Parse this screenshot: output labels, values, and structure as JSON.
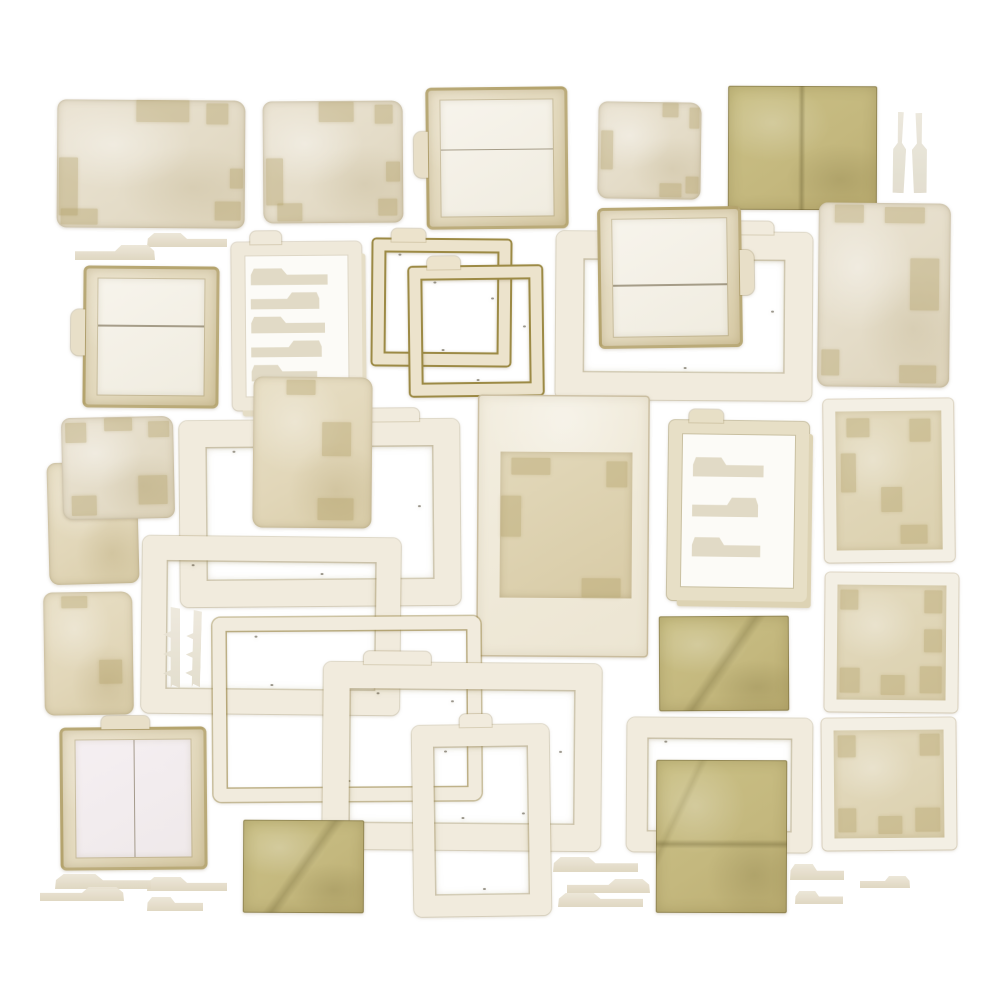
{
  "meta": {
    "description": "Vintage paper ephemera collage: distressed photo frames, file folders, tab strips and olive paper squares laid out on a white background",
    "board": {
      "width": 1000,
      "height": 1000,
      "background": "#ffffff"
    }
  },
  "palette": {
    "background": "#ffffff",
    "cream_paper": "#e9e2d1",
    "tan_paper": "#e3d9bd",
    "frame_white": "#f1ebdd",
    "gold_edge": "#9c8a45",
    "olive_sheet": "#c6bb84",
    "tape_patch": "#b09e64",
    "ghost_tab": "#cbc09e",
    "panel_white": "#f6f3ec",
    "panel_pink": "#f3edf0"
  },
  "pieces": [
    {
      "name": "card-landscape-1",
      "type": "card",
      "x": 57,
      "y": 100,
      "w": 188,
      "h": 128,
      "rot": 0.4,
      "patches": [
        [
          0.42,
          0.0,
          0.28,
          0.17
        ],
        [
          0.79,
          0.02,
          0.12,
          0.17
        ],
        [
          0.01,
          0.45,
          0.1,
          0.46
        ],
        [
          0.92,
          0.53,
          0.07,
          0.16
        ],
        [
          0.02,
          0.85,
          0.2,
          0.13
        ],
        [
          0.84,
          0.79,
          0.14,
          0.15
        ]
      ]
    },
    {
      "name": "card-landscape-2",
      "type": "card",
      "x": 263,
      "y": 101,
      "w": 140,
      "h": 122,
      "rot": -0.4,
      "patches": [
        [
          0.4,
          0.01,
          0.25,
          0.16
        ],
        [
          0.8,
          0.03,
          0.13,
          0.16
        ],
        [
          0.02,
          0.47,
          0.12,
          0.38
        ],
        [
          0.88,
          0.5,
          0.1,
          0.16
        ],
        [
          0.1,
          0.84,
          0.18,
          0.14
        ],
        [
          0.82,
          0.8,
          0.14,
          0.14
        ]
      ]
    },
    {
      "name": "folder-frame-top",
      "type": "folderframe",
      "x": 426,
      "y": 87,
      "w": 142,
      "h": 142,
      "rot": -0.6,
      "divide": "h",
      "divideAt": 0.42,
      "tab": "left"
    },
    {
      "name": "card-square-1",
      "type": "card",
      "x": 598,
      "y": 102,
      "w": 103,
      "h": 97,
      "rot": 0.8,
      "patches": [
        [
          0.62,
          0.01,
          0.16,
          0.14
        ],
        [
          0.88,
          0.05,
          0.1,
          0.22
        ],
        [
          0.03,
          0.3,
          0.12,
          0.4
        ],
        [
          0.6,
          0.84,
          0.22,
          0.14
        ],
        [
          0.85,
          0.76,
          0.13,
          0.18
        ]
      ]
    },
    {
      "name": "olive-folded-sheet",
      "type": "olive",
      "x": 728,
      "y": 86,
      "w": 149,
      "h": 124,
      "rot": 0.2,
      "fold": "v"
    },
    {
      "name": "slim-strip-1",
      "type": "strip",
      "x": 893,
      "y": 112,
      "w": 13,
      "h": 81,
      "rot": 2
    },
    {
      "name": "slim-strip-2",
      "type": "strip",
      "x": 912,
      "y": 113,
      "w": 15,
      "h": 80,
      "rot": -1
    },
    {
      "name": "tab-strip-upper-1",
      "type": "tab",
      "x": 147,
      "y": 233,
      "w": 80,
      "h": 14,
      "rot": 0
    },
    {
      "name": "tab-strip-upper-2",
      "type": "tab",
      "x": 75,
      "y": 245,
      "w": 80,
      "h": 15,
      "rot": 0,
      "flip": true
    },
    {
      "name": "folder-frame-left",
      "type": "folderframe",
      "x": 83,
      "y": 266,
      "w": 136,
      "h": 142,
      "rot": 0.5,
      "divide": "h",
      "divideAt": 0.4,
      "tab": "left"
    },
    {
      "name": "tab-pocket-sheet-1",
      "type": "tabsheet",
      "x": 232,
      "y": 242,
      "w": 130,
      "h": 168,
      "rot": -0.5,
      "rows": 5,
      "tab": "top-left"
    },
    {
      "name": "gold-frame-1",
      "type": "goldframe",
      "x": 373,
      "y": 240,
      "w": 137,
      "h": 125,
      "rot": 0.5,
      "tab": "top-left"
    },
    {
      "name": "gold-frame-2",
      "type": "goldframe",
      "x": 410,
      "y": 267,
      "w": 132,
      "h": 128,
      "rot": -0.7,
      "tab": "top-left"
    },
    {
      "name": "large-frame-1",
      "type": "frame",
      "x": 556,
      "y": 232,
      "w": 256,
      "h": 168,
      "rot": 0.4,
      "bw": 27,
      "tab": "top-right"
    },
    {
      "name": "folder-frame-center",
      "type": "folderframe",
      "x": 598,
      "y": 207,
      "w": 144,
      "h": 141,
      "rot": -0.8,
      "divide": "h",
      "divideAt": 0.56,
      "tab": "right"
    },
    {
      "name": "card-portrait-1",
      "type": "card",
      "x": 818,
      "y": 203,
      "w": 132,
      "h": 184,
      "rot": 0.6,
      "patches": [
        [
          0.12,
          0.01,
          0.22,
          0.1
        ],
        [
          0.5,
          0.02,
          0.3,
          0.09
        ],
        [
          0.7,
          0.3,
          0.22,
          0.28
        ],
        [
          0.03,
          0.8,
          0.14,
          0.14
        ],
        [
          0.62,
          0.88,
          0.28,
          0.1
        ]
      ]
    },
    {
      "name": "sheet-under-left",
      "type": "card",
      "x": 48,
      "y": 462,
      "w": 90,
      "h": 122,
      "rot": -1.5,
      "alt": true,
      "patches": [
        [
          0.55,
          0.05,
          0.3,
          0.12
        ]
      ]
    },
    {
      "name": "folder-square-left",
      "type": "card",
      "x": 62,
      "y": 417,
      "w": 112,
      "h": 102,
      "rot": -1.2,
      "patches": [
        [
          0.04,
          0.05,
          0.18,
          0.2
        ],
        [
          0.38,
          0.01,
          0.25,
          0.13
        ],
        [
          0.68,
          0.58,
          0.26,
          0.28
        ],
        [
          0.08,
          0.76,
          0.22,
          0.2
        ],
        [
          0.78,
          0.05,
          0.18,
          0.16
        ]
      ]
    },
    {
      "name": "large-frame-2",
      "type": "frame",
      "x": 180,
      "y": 420,
      "w": 280,
      "h": 186,
      "rot": -0.5,
      "bw": 26,
      "tab": "top-right"
    },
    {
      "name": "card-portrait-2",
      "type": "card",
      "x": 253,
      "y": 377,
      "w": 119,
      "h": 151,
      "rot": 0.5,
      "alt": true,
      "patches": [
        [
          0.28,
          0.02,
          0.24,
          0.1
        ],
        [
          0.58,
          0.3,
          0.24,
          0.22
        ],
        [
          0.55,
          0.8,
          0.3,
          0.15
        ]
      ]
    },
    {
      "name": "polaroid-frame",
      "type": "polaroid",
      "x": 477,
      "y": 395,
      "w": 172,
      "h": 262,
      "rot": 0.4,
      "pad": [
        57,
        17,
        59,
        23
      ],
      "patches": [
        [
          0.08,
          0.04,
          0.3,
          0.12
        ],
        [
          0.01,
          0.3,
          0.15,
          0.28
        ],
        [
          0.62,
          0.86,
          0.3,
          0.13
        ],
        [
          0.8,
          0.06,
          0.16,
          0.18
        ]
      ]
    },
    {
      "name": "tab-pocket-sheet-2",
      "type": "tabsheet",
      "x": 668,
      "y": 421,
      "w": 140,
      "h": 180,
      "rot": 0.8,
      "rows": 3,
      "tinted": true,
      "tab": "top-left"
    },
    {
      "name": "framed-card-1",
      "type": "framedcard",
      "x": 824,
      "y": 399,
      "w": 130,
      "h": 163,
      "rot": -0.6,
      "patches": [
        [
          0.1,
          0.05,
          0.22,
          0.14
        ],
        [
          0.05,
          0.3,
          0.14,
          0.28
        ],
        [
          0.7,
          0.06,
          0.2,
          0.16
        ],
        [
          0.6,
          0.82,
          0.26,
          0.14
        ],
        [
          0.42,
          0.55,
          0.2,
          0.18
        ]
      ]
    },
    {
      "name": "mid-frame-1",
      "type": "frame",
      "x": 142,
      "y": 537,
      "w": 258,
      "h": 177,
      "rot": 0.6,
      "bw": 24
    },
    {
      "name": "comb-strip-1",
      "type": "comb",
      "x": 163,
      "y": 607,
      "w": 17,
      "h": 81,
      "rot": 0
    },
    {
      "name": "comb-strip-2",
      "type": "comb",
      "x": 186,
      "y": 610,
      "w": 15,
      "h": 77,
      "rot": 1.5
    },
    {
      "name": "card-portrait-3",
      "type": "card",
      "x": 44,
      "y": 592,
      "w": 89,
      "h": 123,
      "rot": -0.8,
      "alt": true,
      "patches": [
        [
          0.2,
          0.03,
          0.3,
          0.1
        ],
        [
          0.62,
          0.55,
          0.26,
          0.2
        ]
      ]
    },
    {
      "name": "thin-frame-1",
      "type": "frame",
      "x": 213,
      "y": 617,
      "w": 268,
      "h": 184,
      "rot": -0.4,
      "bw": 13,
      "goldTint": true
    },
    {
      "name": "large-frame-3",
      "type": "frame",
      "x": 323,
      "y": 663,
      "w": 278,
      "h": 187,
      "rot": 0.5,
      "bw": 26,
      "tab": "top-left"
    },
    {
      "name": "tall-frame-1",
      "type": "frame",
      "x": 413,
      "y": 725,
      "w": 137,
      "h": 191,
      "rot": -0.8,
      "bw": 21,
      "tab": "top"
    },
    {
      "name": "folder-frame-bottom-left",
      "type": "folderframe",
      "x": 60,
      "y": 727,
      "w": 147,
      "h": 143,
      "rot": -0.5,
      "divide": "v",
      "divideAt": 0.5,
      "pink": true,
      "tab": "top"
    },
    {
      "name": "olive-square-1",
      "type": "olive",
      "x": 243,
      "y": 820,
      "w": 121,
      "h": 93,
      "rot": 0.3,
      "fold": "d"
    },
    {
      "name": "frame-behind-olive",
      "type": "frame",
      "x": 627,
      "y": 718,
      "w": 185,
      "h": 134,
      "rot": 0.4,
      "bw": 20
    },
    {
      "name": "olive-square-2",
      "type": "olive",
      "x": 659,
      "y": 616,
      "w": 130,
      "h": 95,
      "rot": -0.3,
      "fold": "d"
    },
    {
      "name": "olive-sheet-large",
      "type": "olive",
      "x": 656,
      "y": 760,
      "w": 131,
      "h": 153,
      "rot": 0.2,
      "fold": "h"
    },
    {
      "name": "framed-square-1",
      "type": "framedcard",
      "x": 825,
      "y": 573,
      "w": 133,
      "h": 139,
      "rot": 0.5,
      "patches": [
        [
          0.03,
          0.04,
          0.16,
          0.18
        ],
        [
          0.8,
          0.04,
          0.16,
          0.2
        ],
        [
          0.03,
          0.72,
          0.18,
          0.22
        ],
        [
          0.76,
          0.7,
          0.2,
          0.24
        ],
        [
          0.4,
          0.78,
          0.22,
          0.18
        ],
        [
          0.8,
          0.38,
          0.16,
          0.2
        ]
      ]
    },
    {
      "name": "framed-square-2",
      "type": "framedcard",
      "x": 822,
      "y": 718,
      "w": 134,
      "h": 132,
      "rot": -0.5,
      "patches": [
        [
          0.04,
          0.05,
          0.16,
          0.2
        ],
        [
          0.78,
          0.04,
          0.18,
          0.2
        ],
        [
          0.04,
          0.72,
          0.16,
          0.22
        ],
        [
          0.74,
          0.72,
          0.22,
          0.22
        ],
        [
          0.4,
          0.8,
          0.22,
          0.16
        ]
      ]
    },
    {
      "name": "tab-strip-bl-1",
      "type": "tab",
      "x": 55,
      "y": 874,
      "w": 96,
      "h": 15,
      "rot": 0
    },
    {
      "name": "tab-strip-bl-2",
      "type": "tab",
      "x": 40,
      "y": 887,
      "w": 84,
      "h": 14,
      "rot": 0,
      "flip": true
    },
    {
      "name": "tab-strip-bl-3",
      "type": "tab",
      "x": 147,
      "y": 877,
      "w": 80,
      "h": 14,
      "rot": 0
    },
    {
      "name": "tab-strip-bl-4",
      "type": "tab",
      "x": 147,
      "y": 897,
      "w": 56,
      "h": 14,
      "rot": 0
    },
    {
      "name": "tab-strip-bc-1",
      "type": "tab",
      "x": 553,
      "y": 857,
      "w": 85,
      "h": 15,
      "rot": 0
    },
    {
      "name": "tab-strip-bc-2",
      "type": "tab",
      "x": 567,
      "y": 879,
      "w": 83,
      "h": 14,
      "rot": 0,
      "flip": true
    },
    {
      "name": "tab-strip-bc-3",
      "type": "tab",
      "x": 558,
      "y": 893,
      "w": 85,
      "h": 14,
      "rot": 0
    },
    {
      "name": "tab-strip-br-1",
      "type": "tab",
      "x": 790,
      "y": 864,
      "w": 54,
      "h": 16,
      "rot": 0
    },
    {
      "name": "tab-strip-br-2",
      "type": "tab",
      "x": 795,
      "y": 891,
      "w": 48,
      "h": 13,
      "rot": 0
    },
    {
      "name": "tab-strip-br-3",
      "type": "tab",
      "x": 860,
      "y": 876,
      "w": 50,
      "h": 12,
      "rot": 0,
      "flip": true
    }
  ]
}
